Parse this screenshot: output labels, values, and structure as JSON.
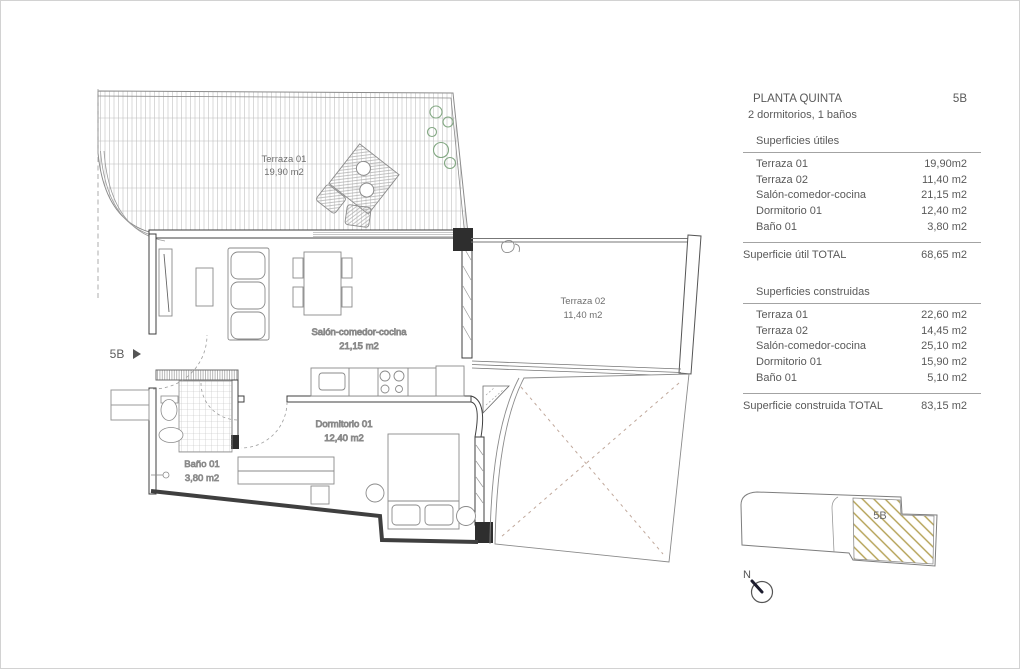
{
  "title_block": {
    "title": "PLANTA QUINTA",
    "unit": "5B",
    "subtitle": "2 dormitorios, 1 baños",
    "useful": {
      "heading": "Superficies útiles",
      "rows": [
        {
          "label": "Terraza 01",
          "value": "19,90m2"
        },
        {
          "label": "Terraza 02",
          "value": "11,40 m2"
        },
        {
          "label": "Salón-comedor-cocina",
          "value": "21,15 m2"
        },
        {
          "label": "Dormitorio 01",
          "value": "12,40 m2"
        },
        {
          "label": "Baño 01",
          "value": "3,80 m2"
        }
      ],
      "total_label": "Superficie útil TOTAL",
      "total_value": "68,65 m2"
    },
    "built": {
      "heading": "Superficies  construidas",
      "rows": [
        {
          "label": "Terraza 01",
          "value": "22,60 m2"
        },
        {
          "label": "Terraza 02",
          "value": "14,45 m2"
        },
        {
          "label": "Salón-comedor-cocina",
          "value": "25,10 m2"
        },
        {
          "label": "Dormitorio 01",
          "value": "15,90 m2"
        },
        {
          "label": "Baño 01",
          "value": "5,10 m2"
        }
      ],
      "total_label": "Superficie construida TOTAL",
      "total_value": "83,15 m2"
    }
  },
  "plan": {
    "entry_label": "5B",
    "rooms": {
      "terraza1": {
        "name": "Terraza 01",
        "area": "19,90 m2"
      },
      "terraza2": {
        "name": "Terraza 02",
        "area": "11,40 m2"
      },
      "salon": {
        "name": "Salón-comedor-cocina",
        "area": "21,15 m2"
      },
      "dormitorio": {
        "name": "Dormitorio 01",
        "area": "12,40 m2"
      },
      "bano": {
        "name": "Baño 01",
        "area": "3,80 m2"
      }
    }
  },
  "key_plan": {
    "unit_label": "5B",
    "north_label": "N",
    "hatch_color": "#b3a052"
  }
}
